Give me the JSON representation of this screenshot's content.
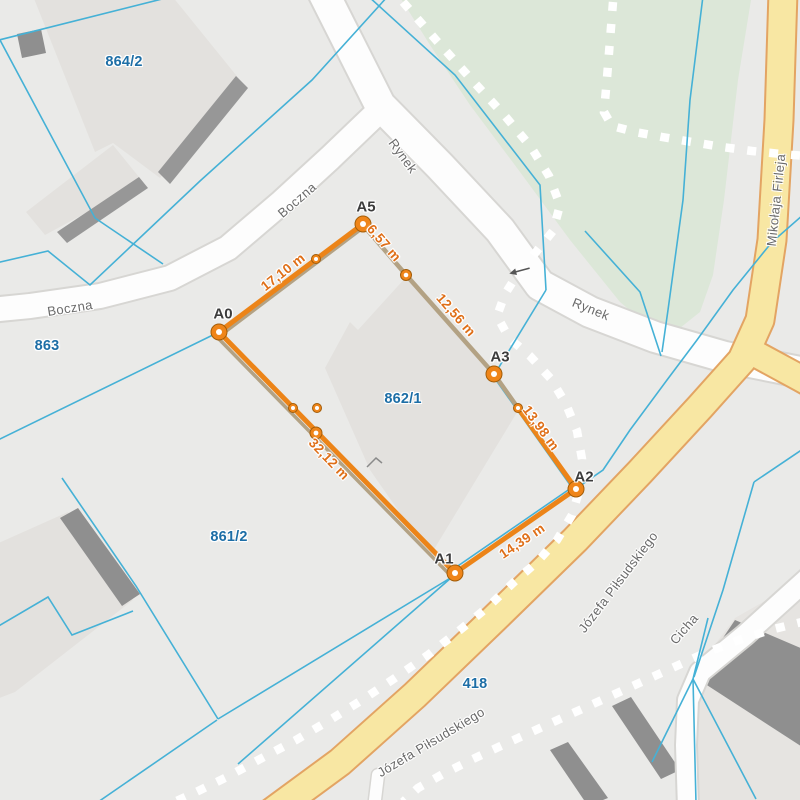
{
  "app": {
    "type": "map-measurement-view"
  },
  "parcels": {
    "p864_2": "864/2",
    "p863": "863",
    "p862_1": "862/1",
    "p861_2": "861/2",
    "p418": "418"
  },
  "streets": {
    "boczna_a": "Boczna",
    "boczna_b": "Boczna",
    "rynek_a": "Rynek",
    "rynek_b": "Rynek",
    "mikolaja_firleja": "Mikołaja Firleja",
    "jozefa_pilsudskiego_a": "Józefa Piłsudskiego",
    "jozefa_pilsudskiego_b": "Józefa Piłsudskiego",
    "cicha": "Cicha"
  },
  "measurement": {
    "vertices": {
      "a0": "A0",
      "a1": "A1",
      "a2": "A2",
      "a3": "A3",
      "a5": "A5"
    },
    "distances": {
      "a0_a5": "17,10 m",
      "a5_a4": "6,57 m",
      "a4_a3": "12,56 m",
      "a3_a2": "13,98 m",
      "a2_a1": "14,39 m",
      "a1_a0": "32,12 m"
    }
  },
  "colors": {
    "measure_line": "#ec8418",
    "measure_label": "#df6f18",
    "measure_secondary": "#b3a284",
    "parcel_line": "#45b1d6",
    "parcel_label": "#1d6ea6",
    "road_yellow": "#f8e7a3",
    "road_yellow_casing": "#e3a463",
    "park_green": "#dce7d8",
    "building_fill": "#e3e1de",
    "building_shadow": "#8f8f8f",
    "footpath_dash": "#ffffff"
  }
}
